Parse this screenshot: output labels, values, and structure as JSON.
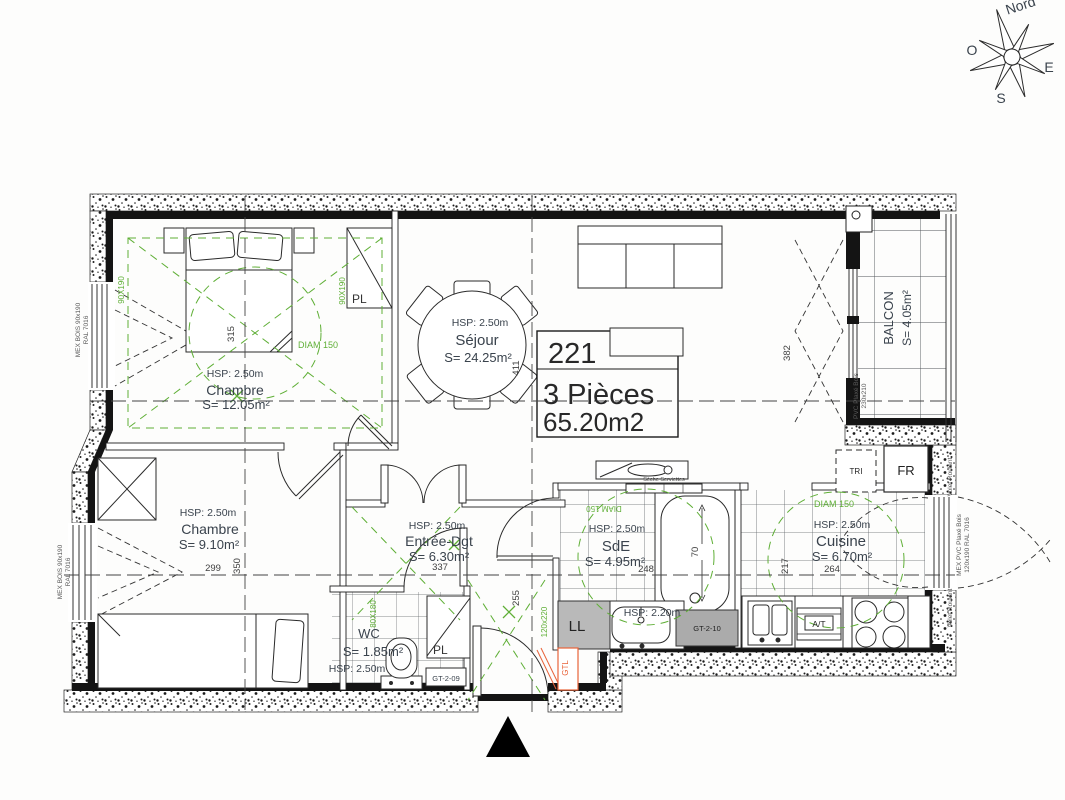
{
  "meta": {
    "drawing": "floor-plan"
  },
  "compass": {
    "north": "Nord",
    "west": "O",
    "east": "E",
    "south": "S"
  },
  "unit_label": {
    "number": "221",
    "type": "3 Pièces",
    "area": "65.20m2"
  },
  "rooms": {
    "chambre1": {
      "hsp": "HSP: 2.50m",
      "name": "Chambre",
      "area": "S= 12.05m²",
      "width_dim": "315",
      "diam": "DIAM 150"
    },
    "sejour": {
      "hsp": "HSP: 2.50m",
      "name": "Séjour",
      "area": "S= 24.25m²",
      "height_dim": "382",
      "width_dim": "411"
    },
    "chambre2": {
      "hsp": "HSP: 2.50m",
      "name": "Chambre",
      "area": "S= 9.10m²",
      "width_dim": "299",
      "height_dim": "350"
    },
    "entree": {
      "hsp": "HSP: 2.50m",
      "name": "Entrée-Dgt",
      "area": "S= 6.30m²",
      "width_dim": "337",
      "height_dim": "255"
    },
    "wc": {
      "name": "WC",
      "area": "S= 1.85m²",
      "hsp": "HSP: 2.50m",
      "size_note": "80X180"
    },
    "sde": {
      "hsp": "HSP: 2.50m",
      "name": "SdE",
      "area": "S= 4.95m²",
      "width_dim": "248",
      "tub_dim": "70",
      "diam": "DIAM 150",
      "towel_dryer": "Sèche Serviettes",
      "soffit": "HSP: 2.20m"
    },
    "cuisine": {
      "hsp": "HSP: 2.50m",
      "name": "Cuisine",
      "area": "S= 6.70m²",
      "width_dim": "264",
      "height_dim": "217",
      "diam": "DIAM 150"
    },
    "balcon": {
      "name": "BALCON",
      "area": "S= 4.05m²"
    }
  },
  "equipment": {
    "closet": "PL",
    "washer": "LL",
    "sorting": "TRI",
    "fridge": "FR",
    "gtl": "GTL",
    "duct_wc": "GT-2-09",
    "duct_sde": "GT-2-10",
    "sink_unit": "A/T"
  },
  "window_specs": {
    "left_type": "MEX BOIS 90x190",
    "left_color": "RAL 7016",
    "right_type": "MEX PVC Plaxé Bois",
    "right_size": "120x190  RAL 7016",
    "shutter": "Volet Roulant",
    "balcony_type": "PVC Plaxé Bois",
    "balcony_size": "230x210",
    "win_90": "90X190",
    "door_entrance": "120x220"
  },
  "colors": {
    "annotation_green": "#5faf36",
    "tech_orange": "#e8633a",
    "wall": "#141414"
  }
}
